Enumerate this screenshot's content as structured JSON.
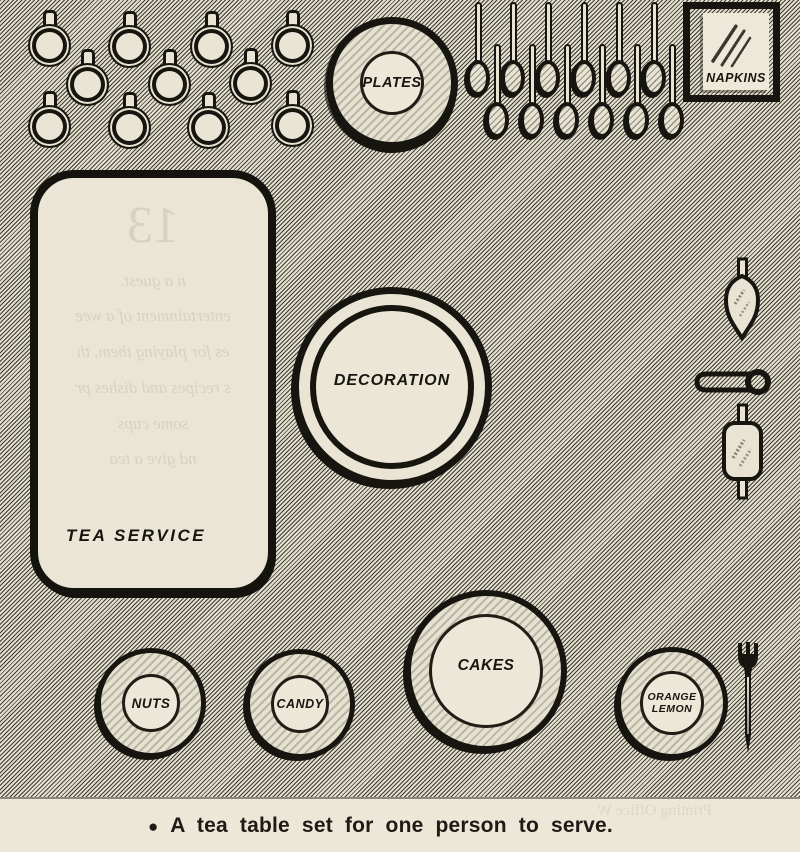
{
  "illustration": {
    "title_context": "tea table diagram",
    "caption": {
      "bullet": "●",
      "text": "A tea table set for one person to serve."
    },
    "labels": {
      "tea_service": "TEA SERVICE",
      "plates": "PLATES",
      "napkins": "NAPKINS",
      "decoration": "DECORATION",
      "nuts": "NUTS",
      "candy": "CANDY",
      "cakes": "CAKES",
      "orange": "ORANGE",
      "lemon": "LEMON"
    },
    "items": {
      "teacups_count": 11,
      "teaspoons_count": 12,
      "icons": [
        "teacup-icon",
        "teaspoon-icon",
        "napkin-fold-lines-icon",
        "leaf-shaped-utensil-icon",
        "tongs-ring-icon",
        "double-handled-utensil-icon",
        "fork-icon"
      ]
    },
    "ghost_text": {
      "tea_service": [
        "13",
        "n a guest.",
        "entertainment of a wee",
        "es for playing them, th",
        "s recipes and dishes pr",
        "some cups",
        "nd give a tea"
      ],
      "caption": "Printing Office  W"
    },
    "colors": {
      "paper": "#e9e4d3",
      "ink": "#17150f",
      "hatch_dark": "#3e3c34",
      "caption_bg": "#ece7d7"
    }
  }
}
